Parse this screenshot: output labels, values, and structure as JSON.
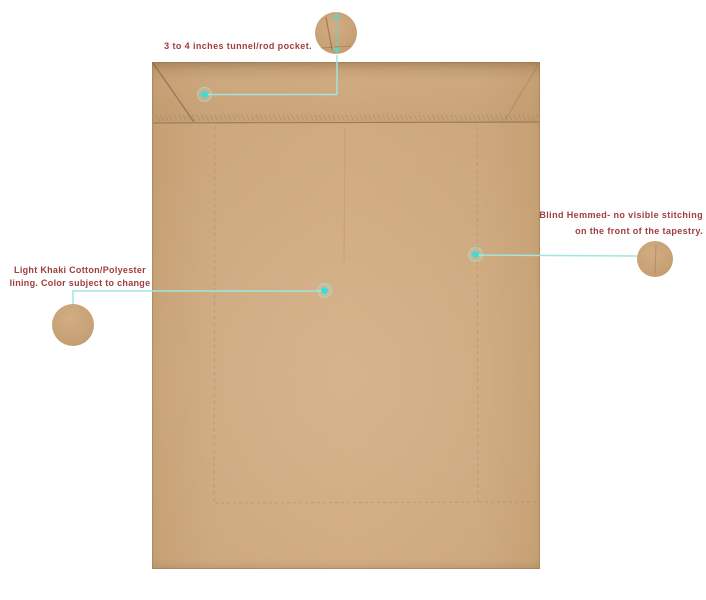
{
  "canvas": {
    "background": "#ffffff"
  },
  "product": {
    "subject": "tapestry-back-view",
    "fabric_color": "#cda87e"
  },
  "colors": {
    "annotation_text": "#a03d3d",
    "leader_line": "#9fe6e0",
    "marker_dot": "#3edcd6",
    "fabric": "#cda87e",
    "stitch": "#8f6f49"
  },
  "annotations": {
    "rod_pocket": {
      "label": "3 to 4 inches tunnel/rod pocket."
    },
    "blind_hem": {
      "line1": "Blind Hemmed- no visible stitching",
      "line2": "on the front of the tapestry."
    },
    "lining": {
      "line1": "Light Khaki Cotton/Polyester",
      "line2": "lining. Color subject to change"
    }
  }
}
